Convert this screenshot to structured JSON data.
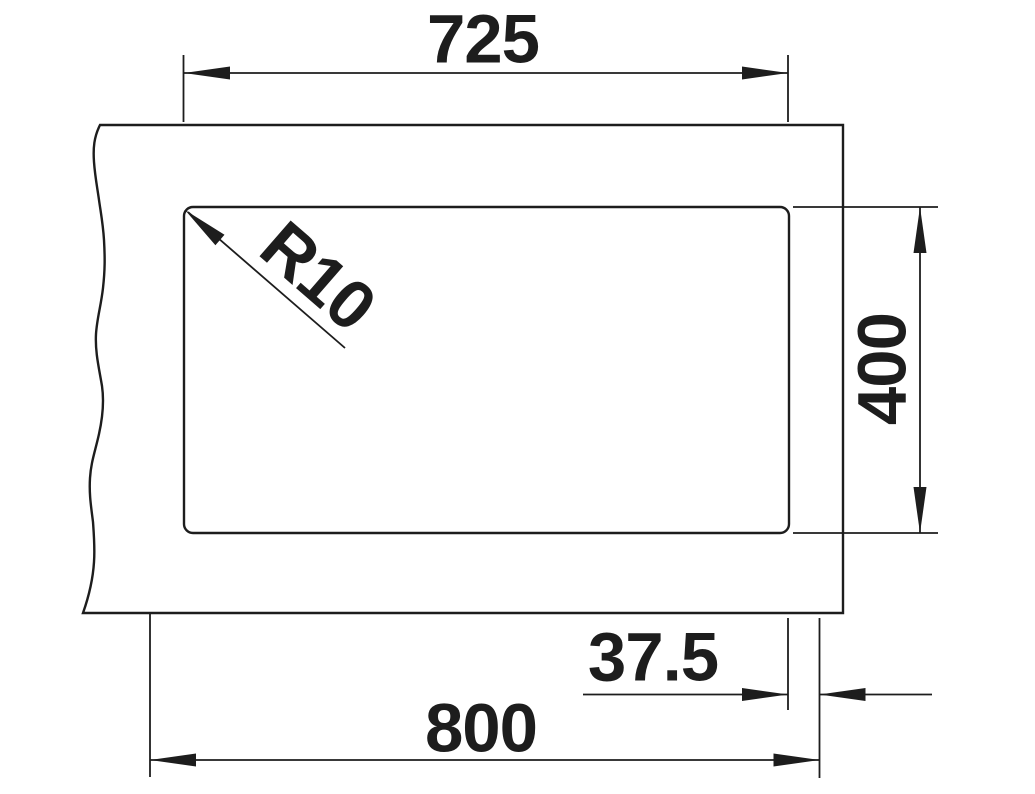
{
  "drawing": {
    "kind": "sink-cutout-dimension-drawing",
    "line_color": "#1d1d1d",
    "background_color": "#ffffff"
  },
  "labels": {
    "cutout_width": "725",
    "corner_radius": "R10",
    "cutout_height": "400",
    "right_offset": "37.5",
    "overall_width": "800"
  }
}
